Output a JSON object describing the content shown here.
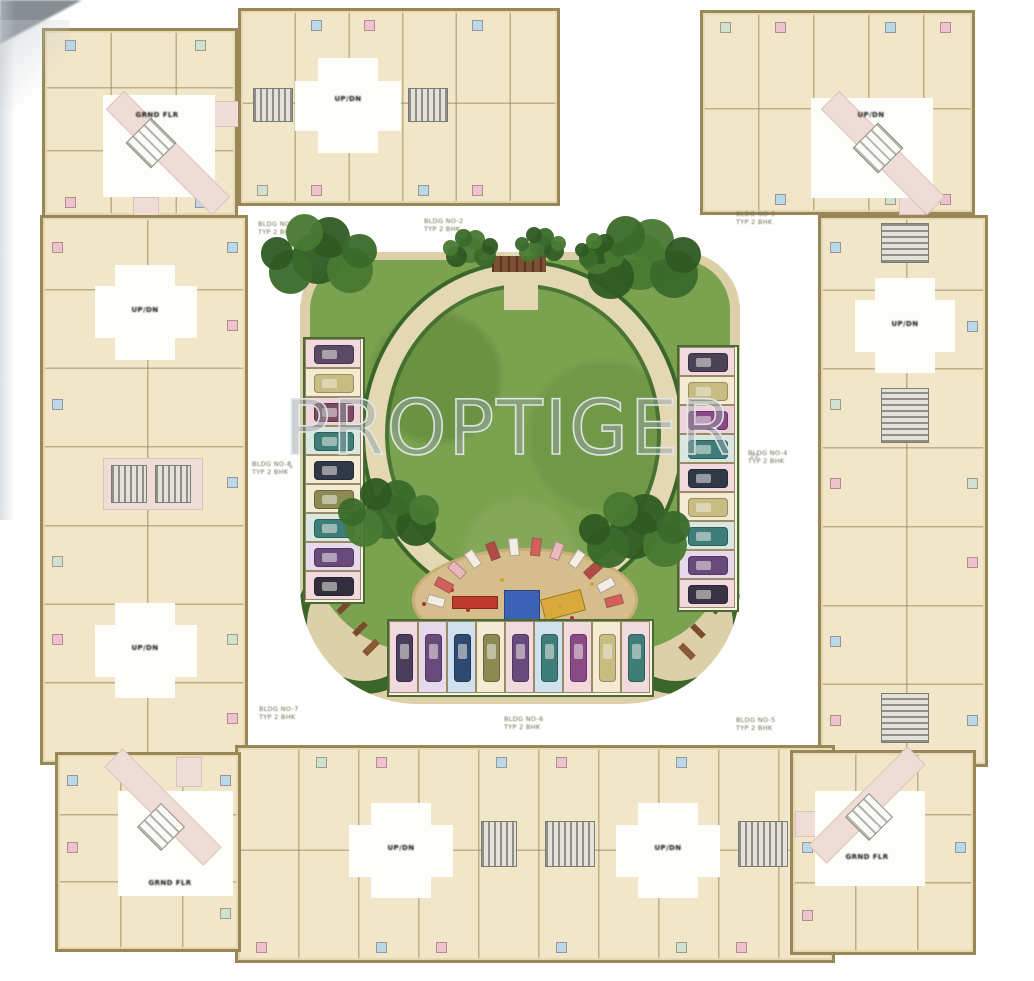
{
  "watermark": {
    "text": "PROPTIGER"
  },
  "colors": {
    "wall": "#9a8757",
    "wall_line": "rgba(150,130,85,0.55)",
    "unit_fill": "#f1e6c8",
    "lobby": "#fdfdfa",
    "corridor_pink": "#f0dcd6",
    "paving": "#ddd0a8",
    "lawn": "#7ba24f",
    "path": "#e3d8b2",
    "hedge": "#3a6629",
    "sand": "#d6bd8c",
    "accent_cycle": [
      "#efc3ce",
      "",
      "#b9d8e8",
      "",
      "#cfe2cb",
      "#efc3ce",
      "",
      "#b9d8e8"
    ],
    "hatch_dark": "#8f8f88",
    "hatch_light": "#e2e2da"
  },
  "core_label_text": "UP/DN",
  "corner_label_text": "GRND FLR",
  "blocks": [
    {
      "id": "corner-tl",
      "x": 42,
      "y": 28,
      "w": 196,
      "h": 190,
      "cols": 3,
      "rows": 3,
      "lobbies": [
        [
          58,
          64,
          112,
          102
        ]
      ],
      "corrs": [
        [
          88,
          166,
          26,
          26
        ],
        [
          168,
          70,
          30,
          26
        ]
      ],
      "bands": [
        [
          123,
          122,
          150,
          26,
          "b"
        ]
      ],
      "diamonds": [
        [
          106,
          112,
          36
        ]
      ],
      "hatches": [],
      "labels": [
        [
          "GRND FLR",
          112,
          84
        ]
      ]
    },
    {
      "id": "wing-top",
      "x": 238,
      "y": 8,
      "w": 322,
      "h": 198,
      "cols": 6,
      "rows": 2,
      "lobbies": [
        [
          77,
          47,
          60,
          95
        ],
        [
          54,
          70,
          106,
          50
        ]
      ],
      "corrs": [],
      "bands": [],
      "diamonds": [],
      "hatches": [
        [
          12,
          77,
          40,
          34,
          "v"
        ],
        [
          167,
          77,
          40,
          34,
          "v"
        ]
      ],
      "labels": [
        [
          "UP/DN",
          107,
          88
        ]
      ]
    },
    {
      "id": "corner-tr",
      "x": 700,
      "y": 10,
      "w": 275,
      "h": 205,
      "cols": 5,
      "rows": 2,
      "lobbies": [
        [
          108,
          85,
          122,
          100
        ]
      ],
      "corrs": [
        [
          196,
          172,
          26,
          30
        ]
      ],
      "bands": [
        [
          180,
          140,
          150,
          26,
          "b"
        ]
      ],
      "diamonds": [
        [
          175,
          135,
          36
        ]
      ],
      "hatches": [],
      "labels": [
        [
          "UP/DN",
          168,
          102
        ]
      ]
    },
    {
      "id": "wing-left",
      "x": 40,
      "y": 215,
      "w": 208,
      "h": 550,
      "cols": 2,
      "rows": 7,
      "lobbies": [
        [
          72,
          47,
          60,
          95
        ],
        [
          52,
          68,
          102,
          52
        ],
        [
          72,
          385,
          60,
          95
        ],
        [
          52,
          407,
          102,
          52
        ]
      ],
      "corrs": [
        [
          60,
          240,
          100,
          52
        ]
      ],
      "bands": [],
      "diamonds": [],
      "hatches": [
        [
          68,
          247,
          36,
          38,
          "v"
        ],
        [
          112,
          247,
          36,
          38,
          "v"
        ]
      ],
      "labels": [
        [
          "UP/DN",
          102,
          92
        ],
        [
          "UP/DN",
          102,
          430
        ]
      ]
    },
    {
      "id": "wing-right",
      "x": 818,
      "y": 215,
      "w": 170,
      "h": 552,
      "cols": 2,
      "rows": 7,
      "lobbies": [
        [
          54,
          60,
          60,
          95
        ],
        [
          34,
          82,
          100,
          52
        ]
      ],
      "corrs": [],
      "bands": [],
      "diamonds": [],
      "hatches": [
        [
          60,
          5,
          48,
          40,
          "h"
        ],
        [
          60,
          170,
          48,
          55,
          "h"
        ],
        [
          60,
          475,
          48,
          50,
          "h"
        ]
      ],
      "labels": [
        [
          "UP/DN",
          84,
          106
        ]
      ]
    },
    {
      "id": "wing-bottom",
      "x": 235,
      "y": 745,
      "w": 600,
      "h": 218,
      "cols": 10,
      "rows": 2,
      "lobbies": [
        [
          133,
          55,
          60,
          95
        ],
        [
          111,
          77,
          104,
          52
        ],
        [
          400,
          55,
          60,
          95
        ],
        [
          378,
          77,
          104,
          52
        ]
      ],
      "corrs": [],
      "bands": [],
      "diamonds": [],
      "hatches": [
        [
          243,
          73,
          36,
          46,
          "v"
        ],
        [
          307,
          73,
          50,
          46,
          "v"
        ],
        [
          500,
          73,
          50,
          46,
          "v"
        ]
      ],
      "labels": [
        [
          "UP/DN",
          163,
          100
        ],
        [
          "UP/DN",
          430,
          100
        ]
      ]
    },
    {
      "id": "corner-bl",
      "x": 55,
      "y": 752,
      "w": 186,
      "h": 200,
      "cols": 3,
      "rows": 3,
      "lobbies": [
        [
          60,
          36,
          115,
          105
        ]
      ],
      "corrs": [
        [
          118,
          2,
          26,
          30
        ]
      ],
      "bands": [
        [
          105,
          52,
          140,
          26,
          "b"
        ]
      ],
      "diamonds": [
        [
          103,
          72,
          34
        ]
      ],
      "hatches": [],
      "labels": [
        [
          "GRND FLR",
          112,
          128
        ]
      ]
    },
    {
      "id": "corner-br",
      "x": 790,
      "y": 750,
      "w": 186,
      "h": 205,
      "cols": 3,
      "rows": 3,
      "lobbies": [
        [
          22,
          38,
          110,
          95
        ]
      ],
      "corrs": [
        [
          2,
          58,
          26,
          26
        ]
      ],
      "bands": [
        [
          74,
          52,
          140,
          26,
          "f"
        ]
      ],
      "diamonds": [
        [
          76,
          64,
          34
        ]
      ],
      "labels": [
        [
          "GRND FLR",
          74,
          104
        ]
      ]
    }
  ],
  "captions": [
    {
      "x": 258,
      "y": 221,
      "lines": [
        "BLDG NO-1",
        "TYP 2 BHK"
      ]
    },
    {
      "x": 424,
      "y": 218,
      "lines": [
        "BLDG NO-2",
        "TYP 2 BHK"
      ]
    },
    {
      "x": 736,
      "y": 211,
      "lines": [
        "BLDG NO-3",
        "TYP 2 BHK"
      ]
    },
    {
      "x": 748,
      "y": 450,
      "lines": [
        "BLDG NO-4",
        "TYP 2 BHK"
      ]
    },
    {
      "x": 736,
      "y": 717,
      "lines": [
        "BLDG NO-5",
        "TYP 2 BHK"
      ]
    },
    {
      "x": 504,
      "y": 716,
      "lines": [
        "BLDG NO-6",
        "TYP 2 BHK"
      ]
    },
    {
      "x": 259,
      "y": 706,
      "lines": [
        "BLDG NO-7",
        "TYP 2 BHK"
      ]
    },
    {
      "x": 252,
      "y": 461,
      "lines": [
        "BLDG NO-8",
        "TYP 2 BHK"
      ]
    }
  ],
  "micro_marks": [
    {
      "x": 289,
      "y": 463,
      "t": "«"
    },
    {
      "x": 750,
      "y": 452,
      "t": "22"
    }
  ],
  "courtyard": {
    "x": 300,
    "y": 252,
    "w": 440,
    "h": 452,
    "ring": {
      "x": 65,
      "y": 12,
      "w": 316,
      "h": 340,
      "thick": 20
    },
    "entry": {
      "x": 204,
      "y": 0,
      "w": 34,
      "h": 58
    },
    "feature": {
      "x": 192,
      "y": 4,
      "w": 54,
      "h": 16,
      "color": "#7d4f33"
    },
    "sand": {
      "x": 112,
      "y": 296,
      "w": 226,
      "h": 104
    },
    "equipment": [
      {
        "x": 152,
        "y": 344,
        "w": 46,
        "h": 13,
        "rot": 0,
        "color": "#c0392f"
      },
      {
        "x": 204,
        "y": 338,
        "w": 36,
        "h": 32,
        "rot": 0,
        "color": "#3a62b5"
      },
      {
        "x": 242,
        "y": 342,
        "w": 42,
        "h": 22,
        "rot": -15,
        "color": "#d9a93c"
      }
    ],
    "dots": [
      [
        150,
        336,
        "#b33327"
      ],
      [
        166,
        356,
        "#b33327"
      ],
      [
        258,
        352,
        "#caa23a"
      ],
      [
        232,
        368,
        "#2f5a9a"
      ],
      [
        122,
        350,
        "#b33327"
      ],
      [
        290,
        330,
        "#caa23a"
      ],
      [
        200,
        326,
        "#caa23a"
      ],
      [
        270,
        364,
        "#b33327"
      ]
    ],
    "planter_arc": {
      "cx": 225,
      "cy": 368,
      "r": 92,
      "start": 195,
      "end": 345,
      "n": 12,
      "colors": [
        "#f2eee4",
        "#d4605c",
        "#e9b7bc",
        "#f2eee4",
        "#b24a48"
      ]
    },
    "benches": [
      [
        36,
        352,
        16,
        6,
        -45,
        "#7a4a2e"
      ],
      [
        52,
        374,
        16,
        6,
        -45,
        "#7a4a2e"
      ],
      [
        20,
        330,
        14,
        6,
        0,
        "#9a6a3a"
      ],
      [
        404,
        352,
        16,
        6,
        45,
        "#7a4a2e"
      ],
      [
        390,
        376,
        16,
        6,
        45,
        "#7a4a2e"
      ],
      [
        420,
        330,
        14,
        6,
        0,
        "#9a6a3a"
      ],
      [
        62,
        392,
        18,
        7,
        -45,
        "#8a5a36"
      ],
      [
        378,
        396,
        18,
        7,
        45,
        "#8a5a36"
      ]
    ]
  },
  "parking": {
    "left_column": {
      "x": 306,
      "y": 340,
      "stall_w": 56,
      "stall_h": 29,
      "count": 9,
      "dir": "h",
      "stalls": [
        {
          "bg": "#f2d9de",
          "car": "#5a4a66"
        },
        {
          "bg": "#f3ecd2",
          "car": "#c9bc82"
        },
        {
          "bg": "#efd3da",
          "car": "#7c4a62"
        },
        {
          "bg": "#d8e8e0",
          "car": "#3e7d78"
        },
        {
          "bg": "#f3ecd2",
          "car": "#30394a"
        },
        {
          "bg": "#f3ecd2",
          "car": "#8a8a52"
        },
        {
          "bg": "#d8e8e0",
          "car": "#3e7d78"
        },
        {
          "bg": "#e6d9ec",
          "car": "#6a4a7c"
        },
        {
          "bg": "#f2d9de",
          "car": "#33303e"
        }
      ]
    },
    "right_column": {
      "x": 680,
      "y": 348,
      "stall_w": 56,
      "stall_h": 29,
      "count": 9,
      "dir": "h",
      "stalls": [
        {
          "bg": "#f2d9de",
          "car": "#4a4258"
        },
        {
          "bg": "#f3ecd2",
          "car": "#c9bc82"
        },
        {
          "bg": "#efd3da",
          "car": "#8a4a86"
        },
        {
          "bg": "#d8e8e0",
          "car": "#3e7d78"
        },
        {
          "bg": "#f2d9de",
          "car": "#30394a"
        },
        {
          "bg": "#f3ecd2",
          "car": "#c9bc82"
        },
        {
          "bg": "#d8e8e0",
          "car": "#3e7d78"
        },
        {
          "bg": "#e6d9ec",
          "car": "#6a4a7c"
        },
        {
          "bg": "#f2d9de",
          "car": "#3a3346"
        }
      ]
    },
    "bottom_row": {
      "x": 390,
      "y": 622,
      "stall_w": 29,
      "stall_h": 72,
      "count": 9,
      "dir": "v",
      "stalls": [
        {
          "bg": "#f2d9de",
          "car": "#4a3e5c"
        },
        {
          "bg": "#e6d9ec",
          "car": "#6a4a7c"
        },
        {
          "bg": "#cfe0ef",
          "car": "#2f4a72"
        },
        {
          "bg": "#f3ecd2",
          "car": "#8a8a52"
        },
        {
          "bg": "#f2d9de",
          "car": "#6a4a7c"
        },
        {
          "bg": "#cfe0ef",
          "car": "#3e7d78"
        },
        {
          "bg": "#f2d9de",
          "car": "#8a4a86"
        },
        {
          "bg": "#f3ecd2",
          "car": "#c9bc82"
        },
        {
          "bg": "#f2d9de",
          "car": "#3e7d78"
        }
      ]
    }
  },
  "trees": [
    [
      318,
      258,
      1.15
    ],
    [
      640,
      262,
      1.2
    ],
    [
      388,
      516,
      1.0
    ],
    [
      634,
      534,
      1.1
    ],
    [
      470,
      250,
      0.55
    ],
    [
      540,
      246,
      0.5
    ],
    [
      600,
      252,
      0.5
    ]
  ]
}
